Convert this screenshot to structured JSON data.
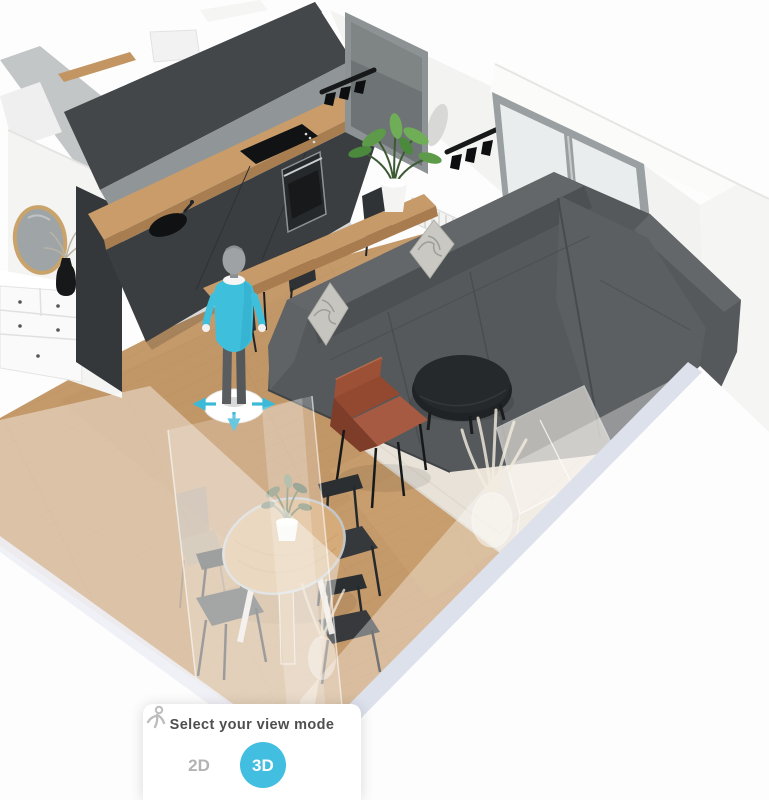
{
  "app": {
    "type": "3d-home-design-planner",
    "canvas_description": "Isometric 3D view of an open plan living room with kitchen and dining area"
  },
  "view_mode_panel": {
    "title": "Select your view mode",
    "accent_color": "#41bee0",
    "inactive_color": "#b3b3b3",
    "options": [
      {
        "label": "2D",
        "selected": false
      },
      {
        "label": "3D",
        "selected": true
      },
      {
        "label": "",
        "icon": "first-person-view-icon",
        "selected": false
      }
    ]
  },
  "scene": {
    "room": "open plan living room with kitchen, lounge and dining corner",
    "palette": {
      "floor_wood": "#c59a6b",
      "kitchen_cabinets": "#3a3e41",
      "countertop_wood": "#c99c6a",
      "walls": "#f6f6f5",
      "sofa_gray": "#55595b",
      "rug_beige": "#e8e2d8",
      "armchair_rust": "#a65a42",
      "avatar_teal": "#3ec0dd",
      "cart_green": "#a9d0ab",
      "wall_cut_strip": "#dde1ec"
    },
    "objects": [
      "dark kitchen cabinets with oven, cooktop and round sink",
      "round wood-framed wall mirror",
      "white dresser with black vase",
      "tall dark window",
      "two black track spotlight fixtures",
      "sliding glass doors to balcony with wooden stool and green bar cart",
      "white radiator",
      "wooden bar counter with potted plant and two dark stools",
      "gray sectional sofa with two marbled pillows",
      "black round coffee table",
      "rust accent armchair",
      "beige area rug",
      "camera avatar mannequin standing on move disc with teal arrows",
      "round wooden dining table with small plant",
      "four dark dining chairs (one ghosted)",
      "translucent cut-away walls with ghost sideboard and pampas vases"
    ]
  }
}
